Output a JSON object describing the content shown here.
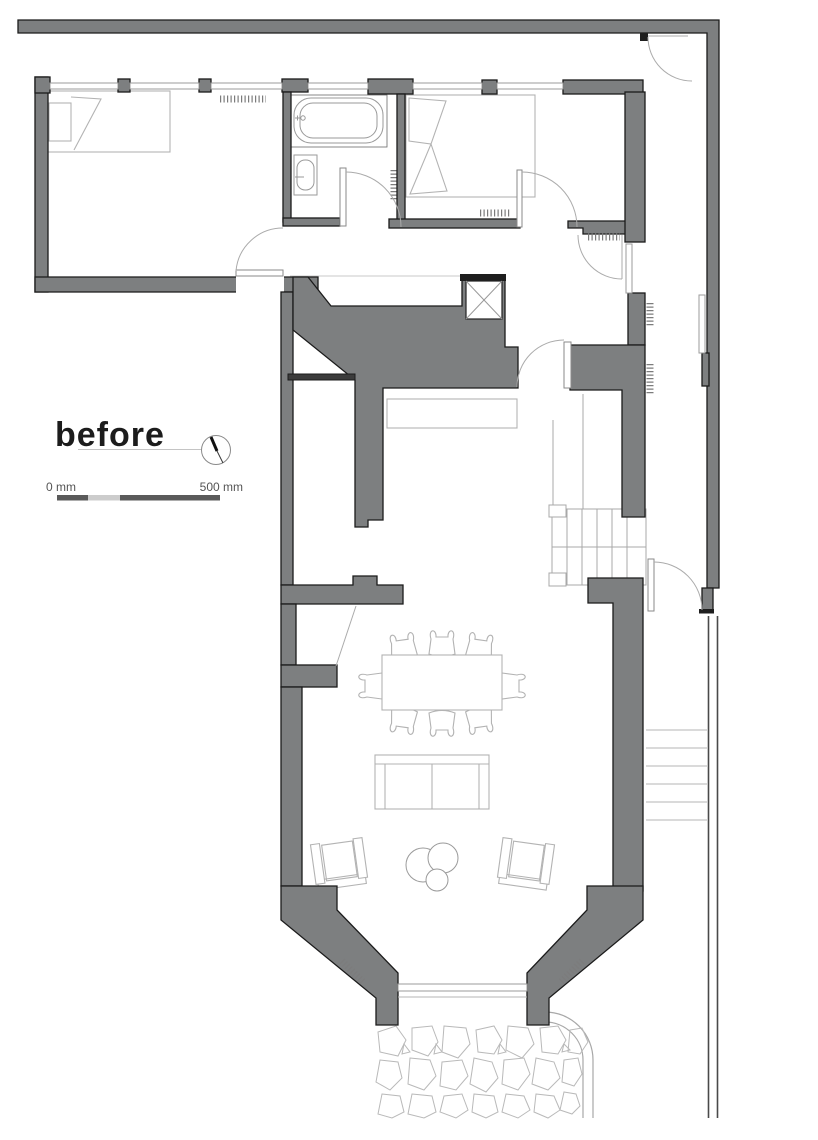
{
  "title": {
    "label": "before"
  },
  "scale_bar": {
    "start_label": "0 mm",
    "end_label": "500 mm"
  },
  "compass": {
    "icon": "north-arrow-icon"
  },
  "colors": {
    "wall_fill": "#7d7f80",
    "wall_outline": "#1b1b1b",
    "furniture_line": "#b3b3b3",
    "fixture_line": "#9a9a9a",
    "door_line": "#ababab",
    "window_line": "#9b9b9b",
    "paving_line": "#b9b9b9",
    "text_dark": "#1c1c1c",
    "text_muted": "#555555",
    "scale_dark": "#5a5a5a",
    "scale_light": "#cccccc"
  },
  "plan": {
    "type": "architectural-floor-plan",
    "phase": "before",
    "rooms": [
      "bedroom-1",
      "bathroom",
      "bedroom-2",
      "hallway",
      "stair-hall",
      "living-dining-room",
      "bay-window",
      "garden-patio"
    ],
    "furniture": [
      "single-bed",
      "double-bed",
      "bathtub",
      "washbasin",
      "duct-shaft",
      "staircase",
      "dining-table",
      "dining-chairs",
      "sofa",
      "armchairs",
      "coffee-table",
      "radiators",
      "garden-steps",
      "crazy-paving"
    ]
  }
}
